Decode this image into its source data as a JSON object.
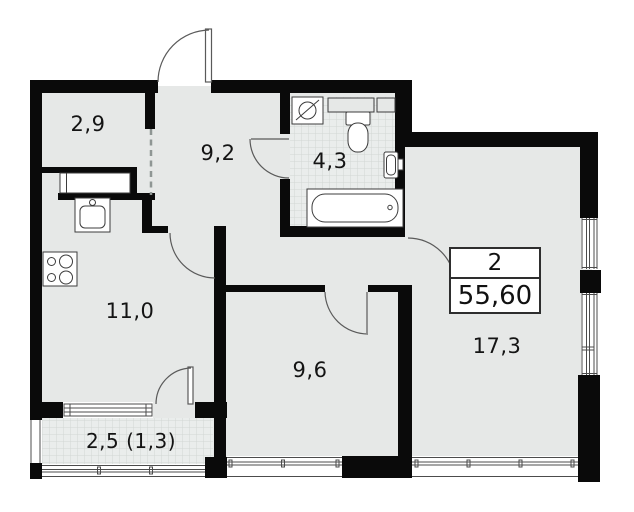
{
  "plan": {
    "type": "apartment-floor-plan",
    "info_box": {
      "rooms_count": "2",
      "total_area_m2": "55,60"
    },
    "rooms": [
      {
        "name": "entry-hall",
        "area": "2,9"
      },
      {
        "name": "corridor",
        "area": "9,2"
      },
      {
        "name": "bathroom",
        "area": "4,3"
      },
      {
        "name": "kitchen",
        "area": "11,0"
      },
      {
        "name": "bedroom",
        "area": "9,6"
      },
      {
        "name": "living-room",
        "area": "17,3"
      },
      {
        "name": "balcony",
        "area": "2,5 (1,3)"
      }
    ],
    "fixtures": [
      "washing-machine",
      "shelf",
      "toilet",
      "bathtub",
      "bathroom-sink",
      "kitchen-sink",
      "stove",
      "wardrobe"
    ],
    "colors": {
      "wall": "#0a0a0a",
      "floor": "#e6e8e7",
      "tile_line": "#d2d6d4",
      "outline": "#4c4c4c",
      "background": "#ffffff"
    }
  }
}
